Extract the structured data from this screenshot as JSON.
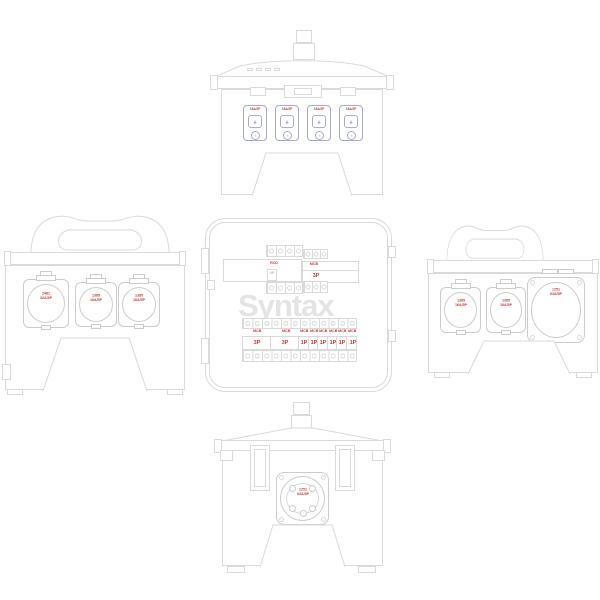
{
  "drawing_title": "Syntax power distribution box - orthographic views",
  "colors": {
    "line": "#dadada",
    "line_dark": "#cccccc",
    "red_label": "#c43c3c",
    "blue_socket": "#a9a9d8",
    "logo_gray": "#e4e4e4"
  },
  "front_panel": {
    "logo": "Syntax",
    "rcd": {
      "label": "RCD",
      "poles": "4P"
    },
    "mcb_top": {
      "label": "MCB",
      "poles": "3P"
    },
    "mcb_row": {
      "label": "MCB",
      "groups": [
        {
          "poles": "3P"
        },
        {
          "poles": "3P"
        }
      ],
      "singles_poles": "1P"
    }
  },
  "top_view": {
    "socket_label": "16A/3P"
  },
  "left_view": {
    "sockets": [
      {
        "code": "2481",
        "rating": "32A/5P"
      },
      {
        "code": "1385",
        "rating": "16A/5P"
      },
      {
        "code": "1385",
        "rating": "16A/5P"
      }
    ]
  },
  "right_view": {
    "sockets": [
      {
        "code": "1385",
        "rating": "16A/5P"
      },
      {
        "code": "1385",
        "rating": "16A/5P"
      },
      {
        "code": "1251",
        "rating": "63A/5P"
      }
    ]
  },
  "bottom_view": {
    "socket": {
      "code": "1251",
      "rating": "63A/5P"
    }
  }
}
